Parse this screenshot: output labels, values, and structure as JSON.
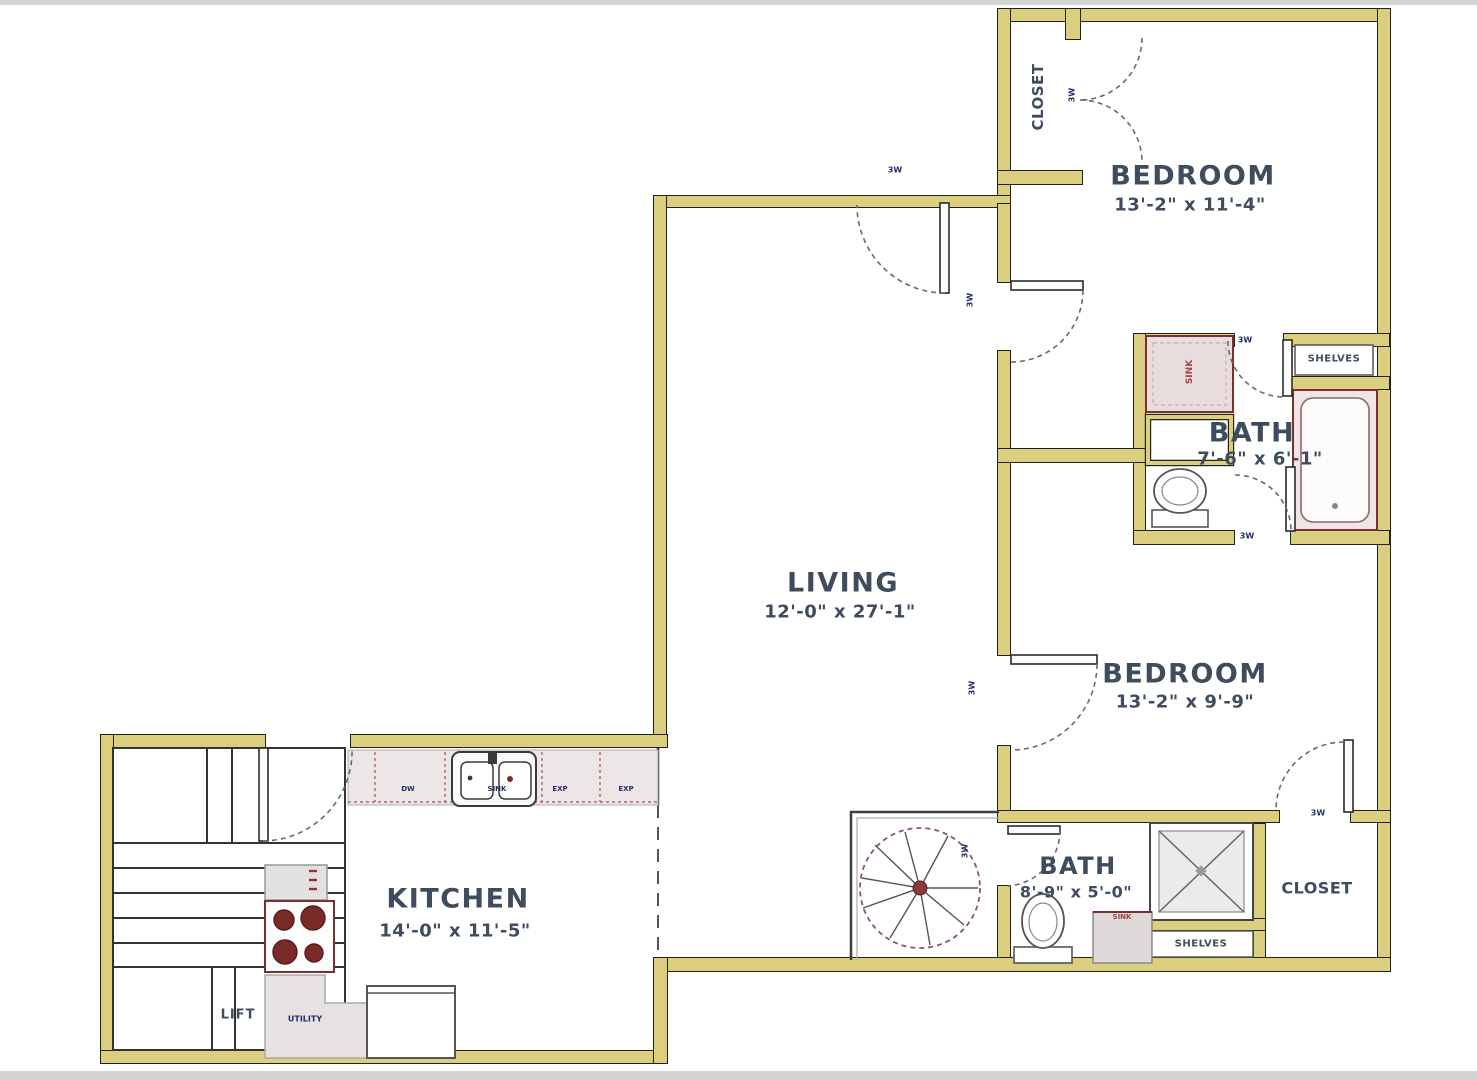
{
  "plan": {
    "rooms": {
      "bedroom1": {
        "name": "BEDROOM",
        "dims": "13'-2\" x 11'-4\""
      },
      "bedroom2": {
        "name": "BEDROOM",
        "dims": "13'-2\" x 9'-9\""
      },
      "living": {
        "name": "LIVING",
        "dims": "12'-0\" x 27'-1\""
      },
      "kitchen": {
        "name": "KITCHEN",
        "dims": "14'-0\" x 11'-5\""
      },
      "bath1": {
        "name": "BATH",
        "dims": "7'-6\" x 6'-1\""
      },
      "bath2": {
        "name": "BATH",
        "dims": "8'-9\" x 5'-0\""
      },
      "closet1": {
        "name": "CLOSET"
      },
      "closet2": {
        "name": "CLOSET"
      }
    },
    "features": {
      "shelves1": "SHELVES",
      "shelves2": "SHELVES",
      "lift": "LIFT",
      "sink1": "SINK",
      "sink2": "SINK",
      "utility": "UTILITY"
    },
    "counter_labels": {
      "dw": "DW",
      "sink": "SINK",
      "exp1": "EXP",
      "exp2": "EXP"
    },
    "door_marker": "3W",
    "colors": {
      "wall_fill": "#dbce7e",
      "wall_edge": "#23231a",
      "room_text": "#3f4c5e",
      "marker_text": "#203066",
      "fixture_red": "#7b2c2c",
      "counter_fill": "#ece6e6",
      "appliance_gray": "#e3e0e0"
    }
  }
}
